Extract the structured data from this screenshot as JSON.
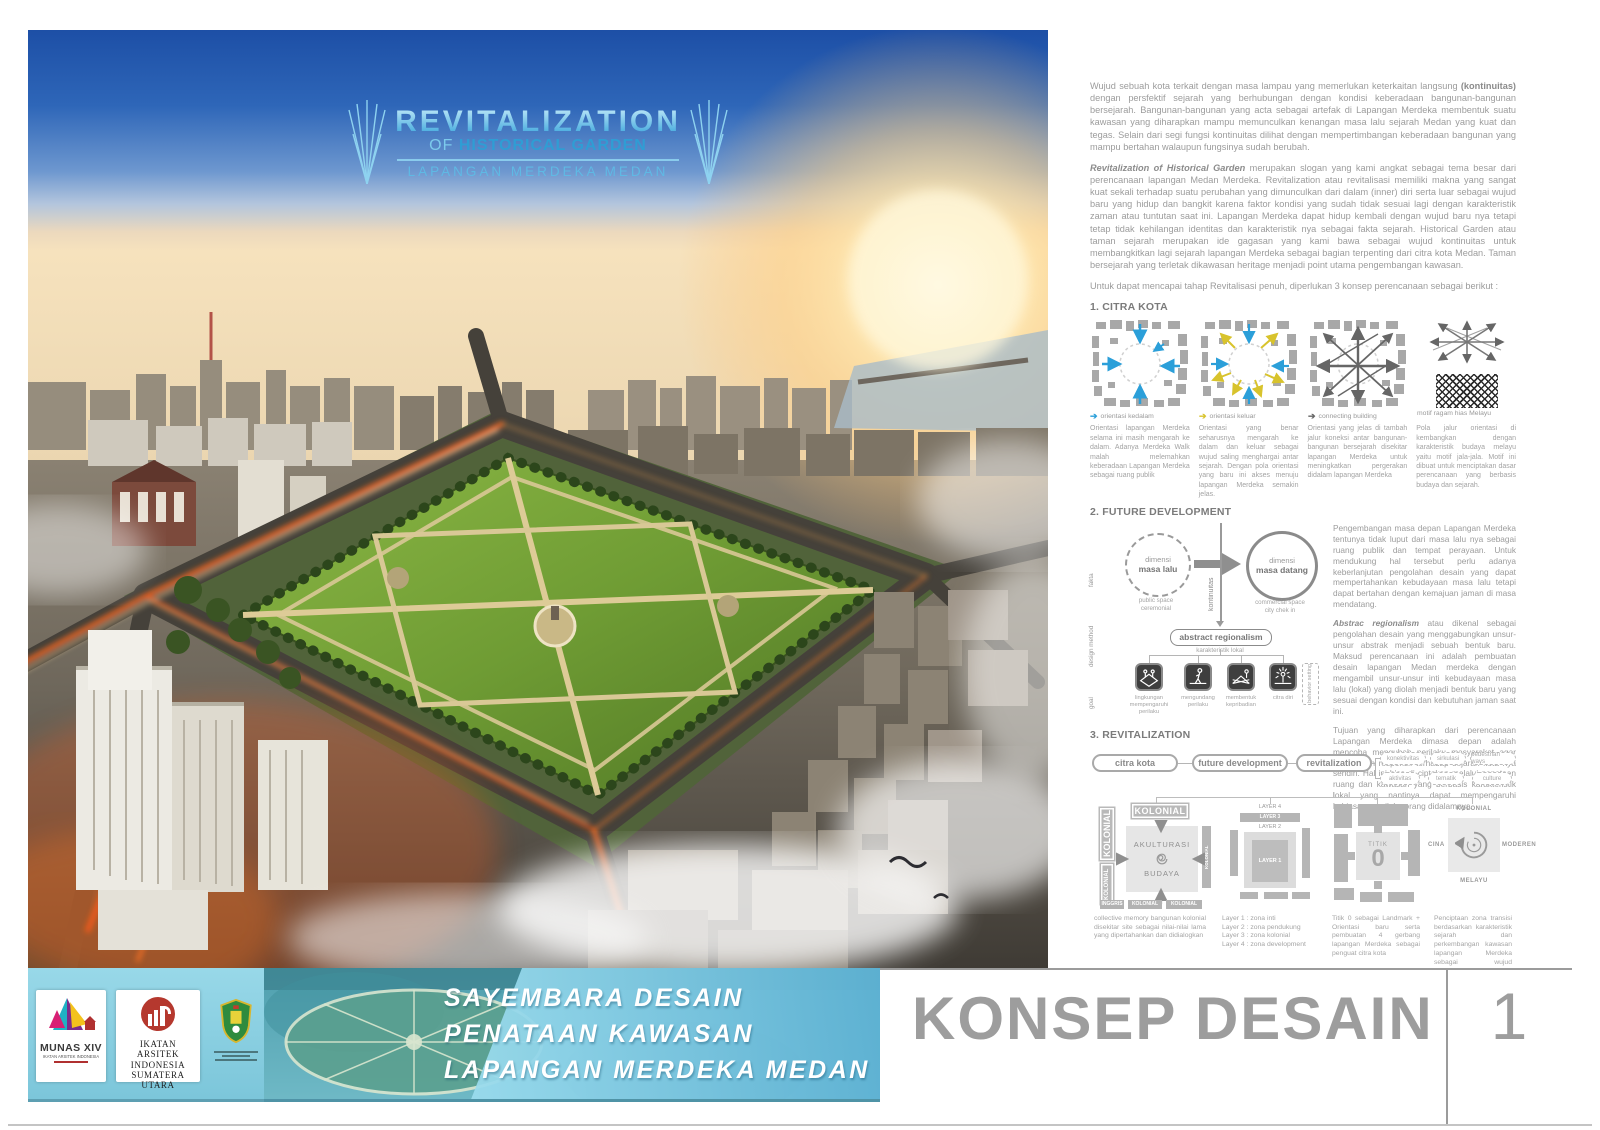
{
  "hero": {
    "title_line1": "REVITALIZATION",
    "title_line2_pre": "OF",
    "title_line2_bold": "HISTORICAL GARDEN",
    "title_line3": "LAPANGAN MERDEKA MEDAN"
  },
  "intro": {
    "p1_a": "Wujud sebuah kota terkait dengan masa lampau yang memerlukan keterkaitan langsung ",
    "p1_bold": "(kontinuitas)",
    "p1_b": " dengan persfektif sejarah yang berhubungan dengan kondisi keberadaan bangunan-bangunan bersejarah. Bangunan-bangunan yang acta sebagai artefak di Lapangan Merdeka membentuk suatu kawasan yang diharapkan mampu memunculkan kenangan masa lalu sejarah Medan yang kuat dan tegas. Selain dari segi fungsi kontinuitas dilihat dengan mempertimbangan keberadaan bangunan yang mampu bertahan walaupun fungsinya sudah berubah.",
    "p2_lead": "Revitalization of Historical Garden",
    "p2": " merupakan slogan yang kami angkat sebagai tema besar dari perencanaan lapangan Medan Merdeka. Revitalization atau revitalisasi memiliki makna yang sangat kuat sekali terhadap suatu perubahan yang dimunculkan dari dalam (inner) diri serta luar sebagai wujud baru yang hidup dan bangkit karena faktor kondisi yang sudah tidak sesuai lagi dengan karakteristik zaman atau tuntutan saat ini. Lapangan Merdeka dapat hidup kembali dengan wujud baru nya tetapi tetap tidak kehilangan identitas dan karakteristik nya sebagai fakta sejarah. Historical Garden atau taman sejarah merupakan ide gagasan yang kami bawa sebagai wujud kontinuitas untuk membangkitkan lagi sejarah lapangan Merdeka sebagai bagian terpenting dari citra kota Medan. Taman bersejarah yang terletak dikawasan heritage menjadi point utama pengembangan kawasan.",
    "p3": "Untuk dapat mencapai tahap Revitalisasi penuh, diperlukan 3 konsep perencanaan sebagai berikut :"
  },
  "citra_kota": {
    "heading": "1. CITRA KOTA",
    "legend1": "orientasi kedalam",
    "legend2": "orientasi keluar",
    "legend3": "connecting building",
    "legend4": "motif ragam hias Melayu",
    "caption1": "Orientasi lapangan Merdeka selama ini masih mengarah ke dalam. Adanya Merdeka Walk malah melemahkan keberadaan Lapangan Merdeka sebagai ruang publik",
    "caption2": "Orientasi yang benar seharusnya mengarah ke dalam dan keluar sebagai wujud saling menghargai antar sejarah. Dengan pola orientasi yang baru ini akses menuju lapangan Merdeka semakin jelas.",
    "caption3": "Orientasi yang jelas di tambah jalur koneksi antar bangunan-bangunan bersejarah disekitar lapangan Merdeka untuk meningkatkan pergerakan didalam lapangan Merdeka",
    "caption4": "Pola jalur orientasi di kembangkan dengan karakteristik budaya melayu yaitu motif jala-jala. Motif ini dibuat untuk menciptakan dasar perencanaan yang berbasis budaya dan sejarah."
  },
  "future": {
    "heading": "2. FUTURE DEVELOPMENT",
    "side_label1": "fakta",
    "side_label2": "design method",
    "side_label3": "goal",
    "circle1_line1": "dimensi",
    "circle1_line2": "masa lalu",
    "circle1_sub1": "public space",
    "circle1_sub2": "ceremonial",
    "circle2_line1": "dimensi",
    "circle2_line2": "masa datang",
    "circle2_sub1": "commercial space",
    "circle2_sub2": "city chek in",
    "kontinuitas": "kontinuitas",
    "method_box": "abstract regionalism",
    "method_sub": "karakteristik lokal",
    "behavior_label": "behavior setting",
    "goal1": "lingkungan mempengaruhi perilaku",
    "goal2": "mengundang perilaku",
    "goal3": "membentuk kepribadian",
    "goal4": "citra diri",
    "p1": "Pengembangan masa depan Lapangan Merdeka tentunya tidak luput dari masa lalu nya sebagai ruang publik dan tempat perayaan. Untuk mendukung hal tersebut perlu adanya keberlanjutan pengolahan desain yang dapat mempertahankan kebudayaan masa lalu tetapi dapat bertahan dengan kemajuan jaman di masa mendatang.",
    "p2_lead": "Abstrac regionalism",
    "p2": " atau dikenal sebagai pengolahan desain yang menggabungkan unsur-unsur abstrak menjadi sebuah bentuk baru. Maksud perencanaan ini adalah pembuatan desain lapangan Medan merdeka dengan mengambil unsur-unsur inti kebudayaan masa lalu (lokal) yang diolah menjadi bentuk baru yang sesuai dengan kondisi dan kebutuhan jaman saat ini.",
    "p3": "Tujuan yang diharapkan dari perencanaan Lapangan Merdeka dimasa depan adalah mencoba mengubah perilaku masyarakat agar dapat lebih responsif terhadap sejarah kota nya sendiri. Hal ini bisa di ciptakan melalui penataan ruang dan kawasan yang berbasis karakteristik lokal yang nantinya dapat mempengaruhi kebiasaan perilaku orang didalamnya."
  },
  "revitalization": {
    "heading": "3. REVITALIZATION",
    "flow1": "citra kota",
    "flow2": "future development",
    "flow3": "revitalization",
    "tag1": "konektivitas",
    "tag2": "sirkulasi",
    "tag3": "pedestrian ways",
    "tag4": "aktivitas",
    "tag5": "tematik",
    "tag6": "culture",
    "d1_top": "KOLONIAL",
    "d1_left1": "KOLONIAL",
    "d1_left2": "KOLONIAL",
    "d1_right": "KOLONIAL",
    "d1_center1": "AKULTURASI",
    "d1_center2": "BUDAYA",
    "d1_bottom1": "INGGRIS",
    "d1_bottom2": "KOLONIAL",
    "d1_bottom3": "KOLONIAL",
    "d2_layer4": "LAYER 4",
    "d2_layer3": "LAYER 3",
    "d2_layer2": "LAYER 2",
    "d2_layer1": "LAYER 1",
    "d3_titik": "TITIK",
    "d3_zero": "0",
    "d4_top": "KOLONIAL",
    "d4_left": "CINA",
    "d4_right": "MODEREN",
    "d4_bottom": "MELAYU",
    "caption1": "collective memory bangunan kolonial disekitar site sebagai nilai-nilai lama yang dipertahankan dan didialogkan",
    "caption2_l1": "Layer 1 : zona inti",
    "caption2_l2": "Layer 2 : zona pendukung",
    "caption2_l3": "Layer 3 : zona kolonial",
    "caption2_l4": "Layer 4 : zona development",
    "caption3": "Titik 0 sebagai Landmark + Orientasi baru serta pembuatan 4 gerbang lapangan Merdeka sebagai penguat citra kota",
    "caption4": "Penciptaan zona transisi berdasarkan karakteristik sejarah dan perkembangan kawasan lapangan Merdeka sebagai wujud penghargaan kepada masa lalu dan masa depan"
  },
  "footer": {
    "munas_title": "MUNAS XIV",
    "munas_sub": "IKATAN ARSITEK INDONESIA",
    "iai_l1": "IKATAN",
    "iai_l2": "ARSITEK",
    "iai_l3": "INDONESIA",
    "iai_l4": "SUMATERA UTARA",
    "banner_l1": "SAYEMBARA DESAIN",
    "banner_l2": "PENATAAN KAWASAN",
    "banner_l3": "LAPANGAN MERDEKA MEDAN",
    "sheet_title": "KONSEP DESAIN",
    "sheet_number": "1"
  },
  "colors": {
    "accent_blue": "#5fb9e4",
    "legend_blue": "#2b9fd9",
    "legend_yellow": "#d8c32c",
    "legend_dark": "#666666",
    "footer_teal": "#8fd2e2",
    "text_gray": "#9a9a9a"
  }
}
